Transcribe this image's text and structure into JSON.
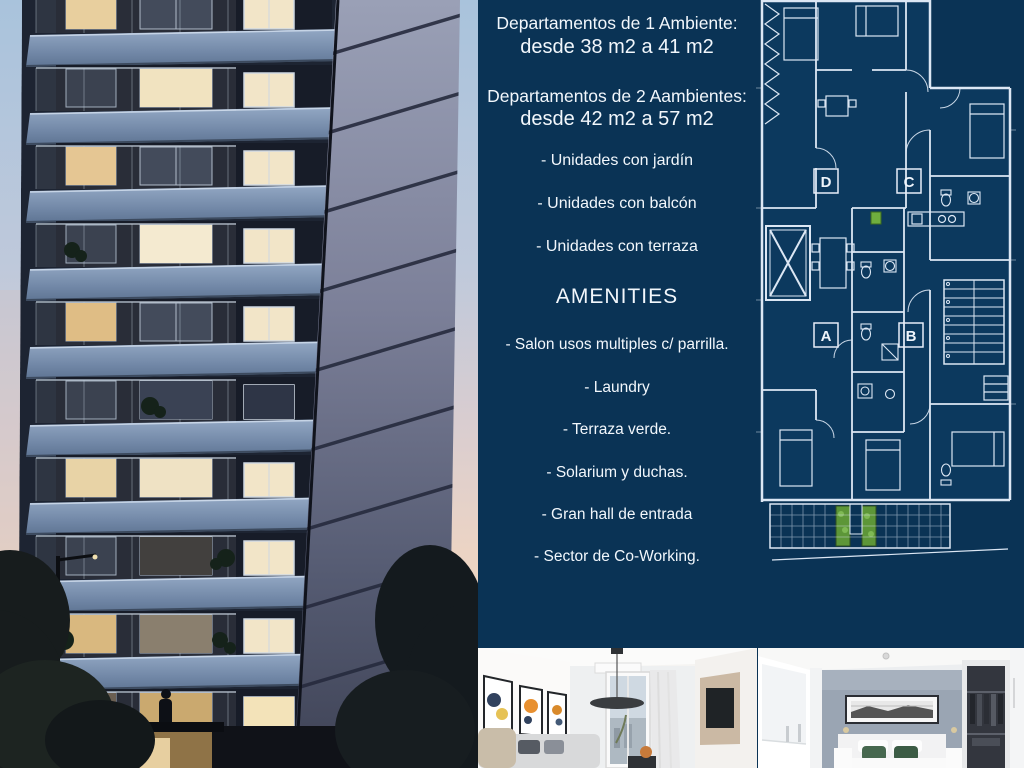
{
  "colors": {
    "background_navy": "#0a3355",
    "blueprint_line": "#dce7f4",
    "text_white": "#f2f7fc",
    "accent_green": "#6da23e"
  },
  "info_panel": {
    "unit1_title": "Departamentos de 1 Ambiente:",
    "unit1_size": "desde 38 m2 a 41 m2",
    "unit2_title": "Departamentos de 2 Aambientes:",
    "unit2_size": "desde 42 m2 a 57 m2",
    "features": [
      "- Unidades con jardín",
      "- Unidades con balcón",
      "- Unidades con terraza"
    ],
    "amenities_title": "AMENITIES",
    "amenities": [
      "- Salon usos multiples c/ parrilla.",
      "- Laundry",
      "- Terraza verde.",
      "- Solarium y duchas.",
      "- Gran hall de entrada",
      "- Sector de Co-Working."
    ]
  },
  "floor_plan": {
    "unit_labels": [
      "D",
      "C",
      "A",
      "B"
    ]
  }
}
